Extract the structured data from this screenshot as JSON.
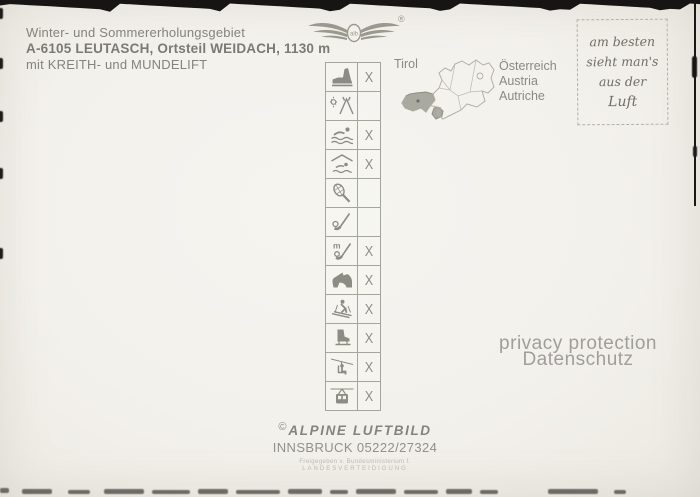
{
  "header": {
    "line1": "Winter- und Sommererholungsgebiet",
    "line2": "A-6105 LEUTASCH, Ortsteil WEIDACH, 1130 m",
    "line3": "mit KREITH- und MUNDELIFT"
  },
  "logo": {
    "name": "alpine-luftbild-wings-logo",
    "monogram": "alb",
    "registered": "®"
  },
  "activities": {
    "items": [
      {
        "icon": "hiking-boot-icon",
        "mark": "X"
      },
      {
        "icon": "camping-tent-icon",
        "mark": ""
      },
      {
        "icon": "swimming-icon",
        "mark": "X"
      },
      {
        "icon": "indoor-pool-icon",
        "mark": "X"
      },
      {
        "icon": "tennis-icon",
        "mark": ""
      },
      {
        "icon": "golf-icon",
        "mark": ""
      },
      {
        "icon": "minigolf-icon",
        "mark": "X"
      },
      {
        "icon": "horse-riding-icon",
        "mark": "X"
      },
      {
        "icon": "skiing-icon",
        "mark": "X"
      },
      {
        "icon": "ice-skating-icon",
        "mark": "X"
      },
      {
        "icon": "chairlift-icon",
        "mark": "X"
      },
      {
        "icon": "cable-car-icon",
        "mark": "X"
      }
    ]
  },
  "map": {
    "region_label": "Tirol",
    "country_labels": [
      "Österreich",
      "Austria",
      "Autriche"
    ]
  },
  "stamp_box": {
    "lines": [
      "am besten",
      "sieht man's",
      "aus der",
      "Luft"
    ]
  },
  "watermark": {
    "line1": "privacy protection",
    "line2": "Datenschutz"
  },
  "credit": {
    "copyright": "©",
    "publisher": "ALPINE LUFTBILD",
    "city_phone": "INNSBRUCK 05222/27324",
    "clearance_line1": "Freigegeben v. Bundesministerium f.",
    "clearance_line2": "LANDESVERTEIDIGUNG"
  },
  "colors": {
    "paper": "#f3f1ec",
    "print_ink": "#84837c",
    "icon_gray": "#8d8c84",
    "tirol_fill": "#aaa9a0",
    "scan_edge": "#161514"
  }
}
